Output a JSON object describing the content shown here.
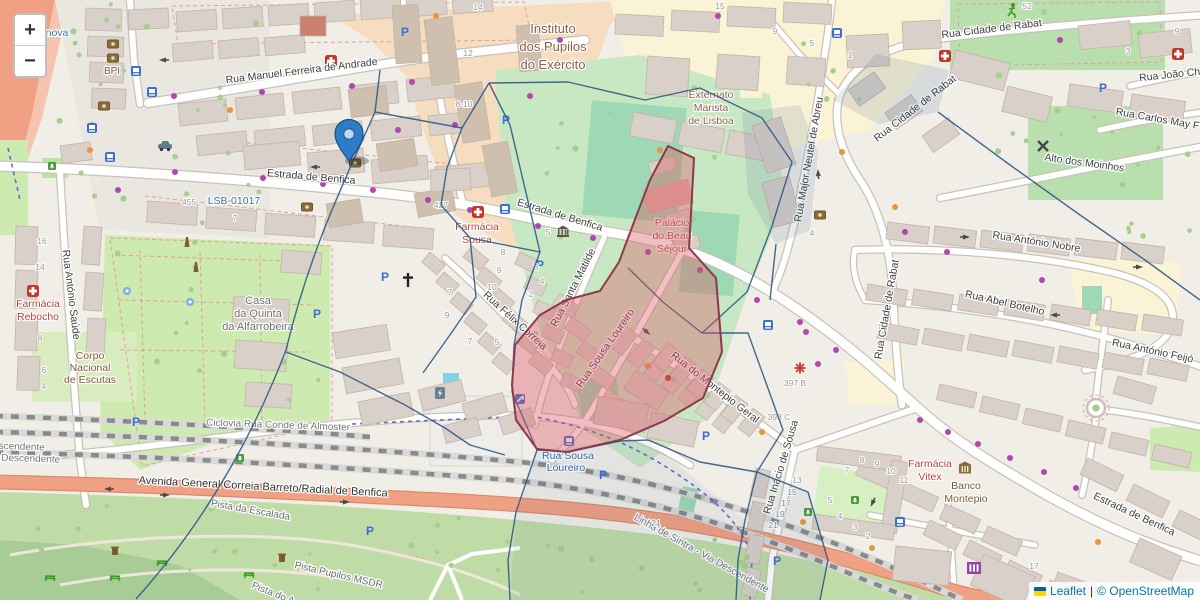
{
  "controls": {
    "zoom_in": "+",
    "zoom_out": "−"
  },
  "attribution": {
    "flag_top_color": "#005BBB",
    "flag_bottom_color": "#FFD500",
    "leaflet_link": "Leaflet",
    "separator": "|",
    "osm_text": "© OpenStreetMap"
  },
  "marker": {
    "name": "location-marker",
    "x": 349,
    "y": 161,
    "color": "#2e7cc7",
    "border": "#1d4f85"
  },
  "colors": {
    "road_casing": "#c9c2b8",
    "road_fill": "#ffffff",
    "trunk_fill": "#f0a183",
    "trunk_casing": "#d98c68",
    "building_fill": "#d9d0c9",
    "building_stroke": "#c2b5a5",
    "park_green": "#cdebb0",
    "grass_bottom": "#c0dca6",
    "pitch_teal": "#9ed8b4",
    "school_peach": "#f6ddc0",
    "school_yellow": "#fbf3d5",
    "overlay_blue": "#2f5a85",
    "overlay_red_stroke": "#8b3a4e",
    "overlay_red_fill": "rgba(222,84,96,0.38)",
    "rail_gray": "#8a8a8a",
    "cycle_blue": "#6a68cf",
    "label_blue": "#3a6ea8",
    "label_red": "#bf4040",
    "label_brown": "#7a5c2e",
    "label_area": "#8d5f45"
  },
  "street_labels": [
    {
      "t": "Rua Manuel Ferreira de Andrade",
      "x": 302,
      "y": 74,
      "r": -7,
      "c": "st"
    },
    {
      "t": "Estrada de Benfica",
      "x": 311,
      "y": 180,
      "r": 5,
      "c": "st"
    },
    {
      "t": "Estrada de Benfica",
      "x": 559,
      "y": 218,
      "r": 17,
      "c": "st"
    },
    {
      "t": "Estrada de Benfica",
      "x": 1133,
      "y": 517,
      "r": 25,
      "c": "st"
    },
    {
      "t": "Rua António Saúde",
      "x": 68,
      "y": 295,
      "r": 83,
      "c": "st"
    },
    {
      "t": "Rua Cidade de Rabat",
      "x": 992,
      "y": 32,
      "r": -7,
      "c": "st"
    },
    {
      "t": "Rua Cidade de Rabat",
      "x": 917,
      "y": 111,
      "r": -38,
      "c": "st"
    },
    {
      "t": "Rua Cidade de Rabat",
      "x": 890,
      "y": 310,
      "r": -80,
      "c": "st"
    },
    {
      "t": "Rua João Ch",
      "x": 1170,
      "y": 78,
      "r": -6,
      "c": "st"
    },
    {
      "t": "Rua Carlos May F",
      "x": 1157,
      "y": 122,
      "r": 10,
      "c": "st"
    },
    {
      "t": "Alto dos Moinhos",
      "x": 1084,
      "y": 166,
      "r": 8,
      "c": "st"
    },
    {
      "t": "Rua António Nobre",
      "x": 1036,
      "y": 245,
      "r": 9,
      "c": "st"
    },
    {
      "t": "Rua Abel Botelho",
      "x": 1004,
      "y": 306,
      "r": 13,
      "c": "st"
    },
    {
      "t": "Rua António Feijó",
      "x": 1152,
      "y": 354,
      "r": 12,
      "c": "st"
    },
    {
      "t": "Rua Major Neutel de Abreu",
      "x": 812,
      "y": 160,
      "r": -80,
      "c": "st"
    },
    {
      "t": "Rua Félix Correia",
      "x": 513,
      "y": 323,
      "r": 42,
      "c": "st"
    },
    {
      "t": "Rua Santa Matilde",
      "x": 576,
      "y": 289,
      "r": -63,
      "c": "st"
    },
    {
      "t": "Rua Sousa Loureiro",
      "x": 608,
      "y": 350,
      "r": -55,
      "c": "st"
    },
    {
      "t": "Rua do Montepio Geral",
      "x": 713,
      "y": 390,
      "r": 38,
      "c": "st"
    },
    {
      "t": "Rua Inácio de Sousa",
      "x": 784,
      "y": 468,
      "r": -73,
      "c": "st"
    },
    {
      "t": "Avenida General Correia Barreto/Radial de Benfica",
      "x": 263,
      "y": 490,
      "r": 3,
      "c": "av"
    },
    {
      "t": "Ciclovia Rua Conde de Almoster",
      "x": 278,
      "y": 428,
      "r": 2,
      "c": "rl"
    },
    {
      "t": "Linha de Sintra - Via Ascendente",
      "x": -28,
      "y": 448,
      "r": 2,
      "c": "rl"
    },
    {
      "t": "Linha de Sintra - Via Descendente",
      "x": -16,
      "y": 460,
      "r": 2,
      "c": "rl"
    },
    {
      "t": "Linha de Sintra - Via Descendente",
      "x": 700,
      "y": 556,
      "r": 29,
      "c": "rl"
    },
    {
      "t": "Pista da Escalada",
      "x": 250,
      "y": 513,
      "r": 10,
      "c": "tr"
    },
    {
      "t": "Pista Pupilos MSDR",
      "x": 338,
      "y": 578,
      "r": 13,
      "c": "tr"
    },
    {
      "t": "Pista do A",
      "x": 272,
      "y": 596,
      "r": 22,
      "c": "tr"
    },
    {
      "t": "LSB-01017",
      "x": 234,
      "y": 204,
      "r": 0,
      "c": "cy"
    },
    {
      "t": "Rua Sousa",
      "x": 568,
      "y": 459,
      "r": 0,
      "c": "cy"
    },
    {
      "t": "Loureiro",
      "x": 566,
      "y": 471,
      "r": 0,
      "c": "cy"
    },
    {
      "t": "nova",
      "x": 57,
      "y": 36,
      "r": 0,
      "c": "cy"
    }
  ],
  "place_labels": [
    {
      "lines": [
        "Instituto",
        "dos Pupilos",
        "do Exército"
      ],
      "x": 553,
      "y": 33,
      "lh": 18,
      "c": "area",
      "s": 13
    },
    {
      "lines": [
        "Externato",
        "Marista",
        "de Lisboa"
      ],
      "x": 711,
      "y": 98,
      "lh": 13,
      "c": "area",
      "s": 10.5
    },
    {
      "lines": [
        "Palácio",
        "do Beau",
        "Séjour"
      ],
      "x": 672,
      "y": 226,
      "lh": 13,
      "c": "area",
      "s": 10.5
    },
    {
      "lines": [
        "Farmácia",
        "Sousa"
      ],
      "x": 477,
      "y": 230,
      "lh": 13,
      "c": "red",
      "s": 10.5
    },
    {
      "lines": [
        "Farmácia",
        "Rebocho"
      ],
      "x": 38,
      "y": 307,
      "lh": 13,
      "c": "red",
      "s": 10.5
    },
    {
      "lines": [
        "Farmácia",
        "Vitex"
      ],
      "x": 930,
      "y": 467,
      "lh": 13,
      "c": "red",
      "s": 10.5
    },
    {
      "lines": [
        "Banco",
        "Montepio"
      ],
      "x": 966,
      "y": 489,
      "lh": 13,
      "c": "brown",
      "s": 10.5
    },
    {
      "lines": [
        "Casa",
        "da Quinta",
        "da Alfarrobeira"
      ],
      "x": 258,
      "y": 304,
      "lh": 13,
      "c": "gray",
      "s": 11
    },
    {
      "lines": [
        "Corpo",
        "Nacional",
        "de Escutas"
      ],
      "x": 90,
      "y": 359,
      "lh": 12,
      "c": "brown",
      "s": 10.5
    },
    {
      "lines": [
        "BPI"
      ],
      "x": 112,
      "y": 74,
      "lh": 12,
      "c": "brown",
      "s": 10
    }
  ],
  "house_numbers": [
    [
      478,
      10,
      "14"
    ],
    [
      468,
      56,
      "12"
    ],
    [
      464,
      107,
      "8-10"
    ],
    [
      189,
      205,
      "455"
    ],
    [
      235,
      221,
      "7"
    ],
    [
      441,
      208,
      "427"
    ],
    [
      42,
      244,
      "16"
    ],
    [
      40,
      270,
      "14"
    ],
    [
      40,
      341,
      "8"
    ],
    [
      44,
      373,
      "6"
    ],
    [
      44,
      389,
      "4"
    ],
    [
      548,
      235,
      "5"
    ],
    [
      536,
      270,
      "3"
    ],
    [
      542,
      284,
      "4"
    ],
    [
      531,
      297,
      "2"
    ],
    [
      503,
      255,
      "8"
    ],
    [
      499,
      273,
      "9"
    ],
    [
      492,
      290,
      "10"
    ],
    [
      450,
      295,
      "7"
    ],
    [
      447,
      318,
      "9"
    ],
    [
      470,
      344,
      "7"
    ],
    [
      497,
      345,
      "5"
    ],
    [
      720,
      9,
      "15"
    ],
    [
      775,
      34,
      "9"
    ],
    [
      1027,
      9,
      "52"
    ],
    [
      1128,
      54,
      "3"
    ],
    [
      1177,
      34,
      "9"
    ],
    [
      850,
      58,
      "1"
    ],
    [
      812,
      46,
      "5"
    ],
    [
      812,
      236,
      "4"
    ],
    [
      795,
      386,
      "397 B"
    ],
    [
      779,
      420,
      "393 C"
    ],
    [
      1034,
      569,
      "17"
    ],
    [
      797,
      483,
      "13"
    ],
    [
      792,
      495,
      "15"
    ],
    [
      786,
      506,
      "17"
    ],
    [
      780,
      517,
      "19"
    ],
    [
      773,
      528,
      "21"
    ],
    [
      830,
      503,
      "5"
    ],
    [
      840,
      519,
      "4"
    ],
    [
      855,
      530,
      "3"
    ],
    [
      868,
      539,
      "2"
    ],
    [
      862,
      463,
      "8"
    ],
    [
      877,
      467,
      "9"
    ],
    [
      891,
      474,
      "10"
    ],
    [
      904,
      483,
      "11"
    ],
    [
      847,
      473,
      "7"
    ],
    [
      656,
      526,
      "21"
    ]
  ],
  "icons": [
    [
      "parking-icon",
      405,
      32
    ],
    [
      "parking-icon",
      506,
      120
    ],
    [
      "parking-icon",
      385,
      277
    ],
    [
      "parking-icon",
      540,
      265
    ],
    [
      "parking-icon",
      317,
      314
    ],
    [
      "parking-icon",
      136,
      422
    ],
    [
      "parking-icon",
      1103,
      88
    ],
    [
      "parking-icon",
      706,
      436
    ],
    [
      "parking-icon",
      603,
      475
    ],
    [
      "parking-icon",
      777,
      561
    ],
    [
      "parking-icon",
      370,
      531
    ],
    [
      "bus-stop-icon",
      136,
      71
    ],
    [
      "bus-stop-icon",
      152,
      92
    ],
    [
      "bus-stop-icon",
      92,
      128
    ],
    [
      "bus-stop-icon",
      110,
      157
    ],
    [
      "bus-stop-icon",
      505,
      209
    ],
    [
      "bus-stop-icon",
      768,
      325
    ],
    [
      "bus-stop-icon",
      900,
      522
    ],
    [
      "bus-stop-icon",
      569,
      441
    ],
    [
      "bus-stop-icon",
      837,
      33
    ],
    [
      "pharmacy-icon",
      478,
      212
    ],
    [
      "pharmacy-icon",
      33,
      291
    ],
    [
      "pharmacy-icon",
      945,
      56
    ],
    [
      "pharmacy-icon",
      1178,
      54
    ],
    [
      "pharmacy-icon",
      331,
      61
    ],
    [
      "atm-icon",
      113,
      44
    ],
    [
      "atm-icon",
      113,
      58
    ],
    [
      "atm-icon",
      104,
      106
    ],
    [
      "atm-icon",
      355,
      163
    ],
    [
      "atm-icon",
      820,
      215
    ],
    [
      "atm-icon",
      307,
      207
    ],
    [
      "bank-icon",
      965,
      469
    ],
    [
      "museum-icon",
      563,
      232
    ],
    [
      "church-icon",
      408,
      280
    ],
    [
      "windmill-icon",
      1043,
      146
    ],
    [
      "runner-icon",
      1012,
      10
    ],
    [
      "taxi-icon",
      165,
      146
    ],
    [
      "charging-station-icon",
      440,
      393
    ],
    [
      "playground-icon",
      520,
      399
    ],
    [
      "attraction-icon",
      974,
      568
    ],
    [
      "burst-icon",
      800,
      368
    ],
    [
      "picnic-icon",
      50,
      577
    ],
    [
      "picnic-icon",
      115,
      577
    ],
    [
      "picnic-icon",
      162,
      562
    ],
    [
      "picnic-icon",
      249,
      574
    ],
    [
      "waste-bin-icon",
      115,
      551
    ],
    [
      "waste-bin-icon",
      282,
      558
    ],
    [
      "memorial-icon",
      187,
      242
    ],
    [
      "memorial-icon",
      196,
      267
    ],
    [
      "fountain-icon",
      127,
      291
    ],
    [
      "fountain-icon",
      190,
      302
    ],
    [
      "playground-green-icon",
      52,
      166
    ],
    [
      "playground-green-icon",
      808,
      512
    ],
    [
      "playground-green-icon",
      855,
      500
    ],
    [
      "playground-green-icon",
      240,
      458
    ]
  ],
  "dots": [
    [
      174,
      96,
      "p"
    ],
    [
      262,
      92,
      "p"
    ],
    [
      352,
      86,
      "p"
    ],
    [
      412,
      82,
      "p"
    ],
    [
      560,
      40,
      "p"
    ],
    [
      718,
      16,
      "p"
    ],
    [
      398,
      130,
      "p"
    ],
    [
      455,
      125,
      "p"
    ],
    [
      175,
      172,
      "p"
    ],
    [
      263,
      178,
      "p"
    ],
    [
      323,
      184,
      "p"
    ],
    [
      373,
      190,
      "p"
    ],
    [
      428,
      200,
      "p"
    ],
    [
      470,
      210,
      "p"
    ],
    [
      538,
      226,
      "p"
    ],
    [
      593,
      238,
      "p"
    ],
    [
      648,
      252,
      "p"
    ],
    [
      700,
      270,
      "p"
    ],
    [
      757,
      300,
      "p"
    ],
    [
      800,
      322,
      "p"
    ],
    [
      836,
      350,
      "p"
    ],
    [
      920,
      420,
      "p"
    ],
    [
      948,
      432,
      "p"
    ],
    [
      978,
      444,
      "p"
    ],
    [
      1010,
      458,
      "p"
    ],
    [
      1044,
      472,
      "p"
    ],
    [
      1076,
      488,
      "p"
    ],
    [
      1108,
      503,
      "p"
    ],
    [
      806,
      332,
      "p"
    ],
    [
      818,
      364,
      "p"
    ],
    [
      905,
      232,
      "p"
    ],
    [
      947,
      252,
      "p"
    ],
    [
      1042,
      280,
      "p"
    ],
    [
      530,
      96,
      "p"
    ],
    [
      118,
      190,
      "p"
    ],
    [
      90,
      150,
      "o"
    ],
    [
      230,
      110,
      "o"
    ],
    [
      352,
      146,
      "o"
    ],
    [
      660,
      150,
      "o"
    ],
    [
      842,
      152,
      "o"
    ],
    [
      895,
      207,
      "o"
    ],
    [
      648,
      366,
      "o"
    ],
    [
      762,
      432,
      "o"
    ],
    [
      803,
      522,
      "o"
    ],
    [
      872,
      548,
      "o"
    ],
    [
      1098,
      542,
      "o"
    ],
    [
      436,
      16,
      "o"
    ],
    [
      1060,
      40,
      "p"
    ],
    [
      668,
      378,
      "r"
    ]
  ],
  "overlays": {
    "blue_paths": [
      "M375,112 L462,128",
      "M462,128 L489,83",
      "M375,112 L380,70",
      "M489,83 L510,125 L540,252 L522,300 L514,345 L512,392 L537,450",
      "M537,450 L516,512 L508,560 L510,600",
      "M375,112 C 345,180 310,250 286,350 C 240,470 180,550 136,599",
      "M286,352 L340,372 L405,405 L445,428 L470,445 L505,455",
      "M462,128 L447,168 L441,205 L470,238 L540,252",
      "M470,238 L476,297 L452,332 L423,373",
      "M489,83 L568,82 L645,100",
      "M645,100 L700,88 L762,118 L792,162 L772,226 L747,292 L702,333",
      "M702,333 L664,303 L628,268",
      "M702,333 L748,333 L783,430 L757,472 L700,462 L648,440 L621,441",
      "M621,441 L568,452 L537,450",
      "M757,472 L745,520 L738,560 L736,600",
      "M757,472 L808,492 L828,560 L820,600",
      "M938,112 L1010,165 L1080,215 L1145,260 L1200,300",
      "M776,244 L770,300"
    ],
    "tinted": [
      {
        "d": "M833,100 L876,54 L949,70 L938,112 L878,124 Z",
        "o": 0.13
      },
      {
        "d": "M742,112 L800,105 L818,152 L810,230 L776,244 L748,195 Z",
        "o": 0.12
      },
      {
        "d": "M537,450 L621,441 L648,440 L745,520 L736,600 L510,600 L516,512 Z",
        "o": 0.07
      },
      {
        "d": "M757,472 L808,492 L828,560 L820,600 L736,600 L745,520 Z",
        "o": 0.08
      }
    ],
    "red_polygon": "M668,146 L694,158 L691,214 L689,248 L716,278 L722,352 L703,398 L664,421 L620,440 L567,452 L537,449 L516,420 L512,385 L515,345 L540,315 L566,300 L600,291 L619,262 L634,222 L650,180 Z"
  }
}
